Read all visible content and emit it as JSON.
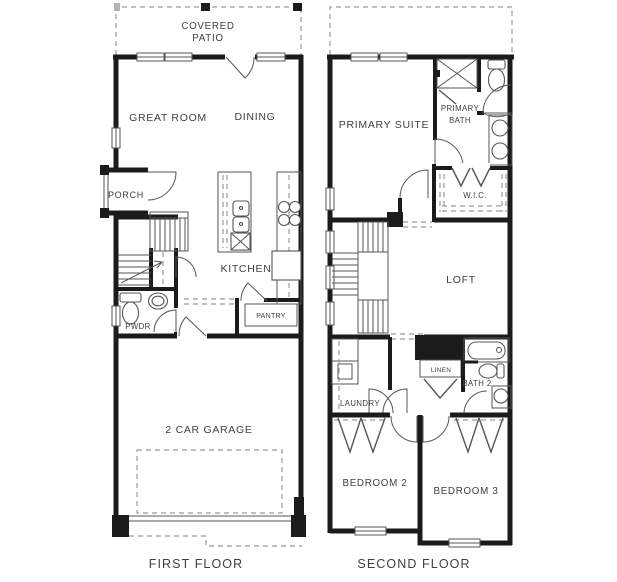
{
  "meta": {
    "type": "residential-floor-plan",
    "sheets": 2
  },
  "colors": {
    "wall": "#1b1b1b",
    "thin_line": "#55565a",
    "dashed_line": "#9a9a9a",
    "text": "#414042",
    "background": "#ffffff"
  },
  "first_floor": {
    "caption": "FIRST FLOOR",
    "labels": {
      "covered_patio_line1": "COVERED",
      "covered_patio_line2": "PATIO",
      "great_room": "GREAT ROOM",
      "dining": "DINING",
      "porch": "PORCH",
      "kitchen": "KITCHEN",
      "pwdr": "PWDR",
      "pantry": "PANTRY",
      "garage": "2 CAR GARAGE"
    }
  },
  "second_floor": {
    "caption": "SECOND FLOOR",
    "labels": {
      "primary_suite": "PRIMARY SUITE",
      "primary_bath_line1": "PRIMARY",
      "primary_bath_line2": "BATH",
      "wic": "W.I.C.",
      "loft": "LOFT",
      "laundry": "LAUNDRY",
      "linen": "LINEN",
      "bath2": "BATH 2",
      "bedroom2": "BEDROOM 2",
      "bedroom3": "BEDROOM 3"
    }
  }
}
